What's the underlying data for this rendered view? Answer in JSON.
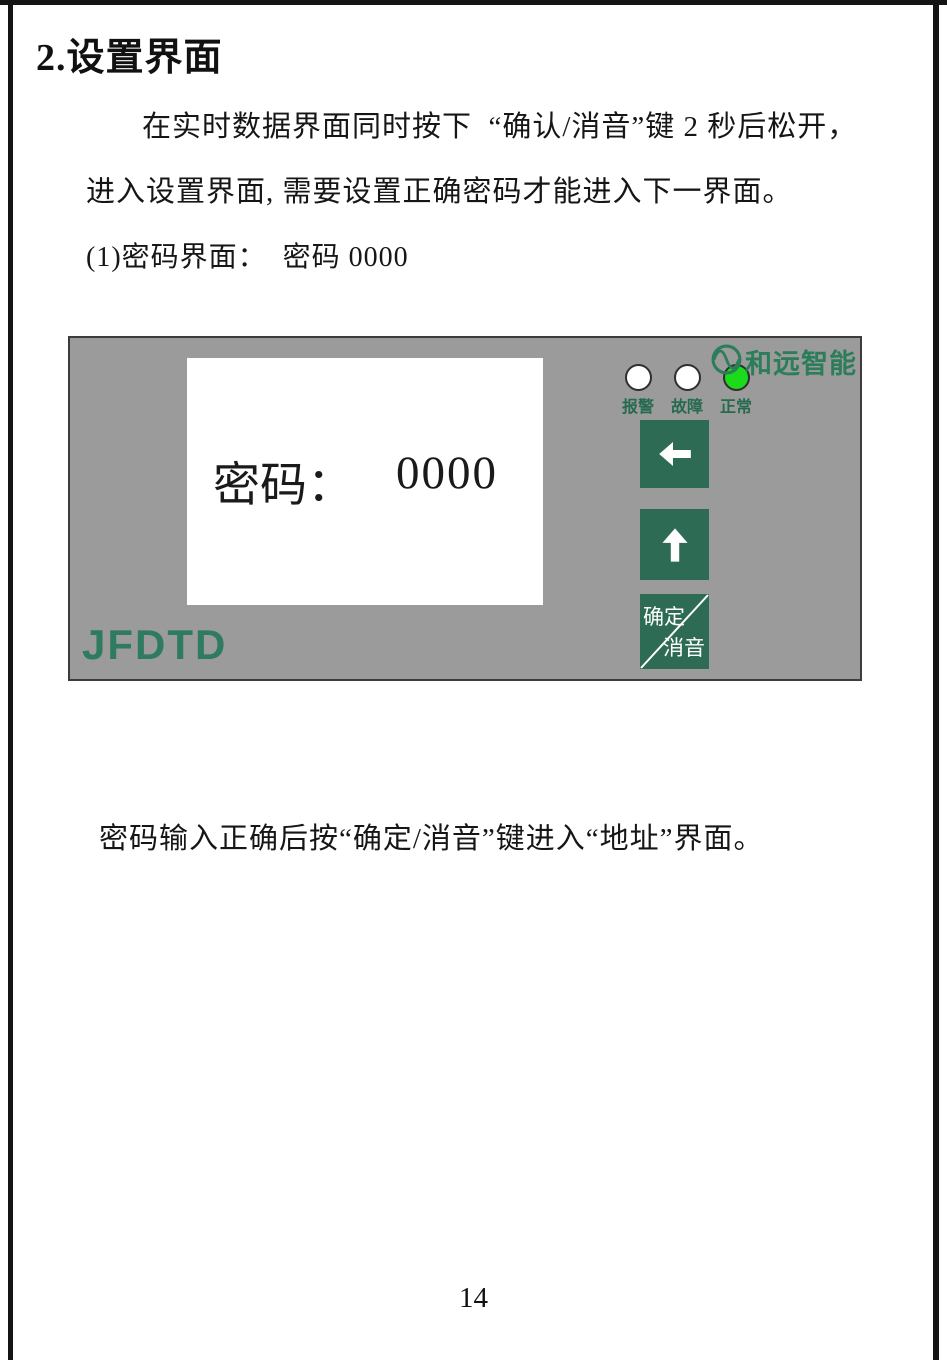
{
  "doc": {
    "title": "2.设置界面",
    "para1_line1": "在实时数据界面同时按下  “确认/消音”键 2 秒后松开，",
    "para1_line2": "进入设置界面, 需要设置正确密码才能进入下一界面。",
    "item1": "(1)密码界面：  密码 0000",
    "para2": "密码输入正确后按“确定/消音”键进入“地址”界面。",
    "page_number": "14"
  },
  "device_panel": {
    "brand": "和远智能",
    "model": "JFDTD",
    "screen": {
      "label": "密码：",
      "value": "0000"
    },
    "leds": [
      {
        "label": "报警",
        "state": "off"
      },
      {
        "label": "故障",
        "state": "off"
      },
      {
        "label": "正常",
        "state": "on"
      }
    ],
    "buttons": {
      "back_icon": "left-arrow",
      "up_icon": "up-arrow",
      "confirm_top": "确定",
      "confirm_bottom": "消音"
    },
    "colors": {
      "panel_bg": "#9b9b9b",
      "button_green": "#2e6b54",
      "brand_green": "#2c7d5a",
      "model_green": "#2e7b5f",
      "led_on_green": "#1bdb1b",
      "led_off_white": "#ffffff"
    }
  }
}
